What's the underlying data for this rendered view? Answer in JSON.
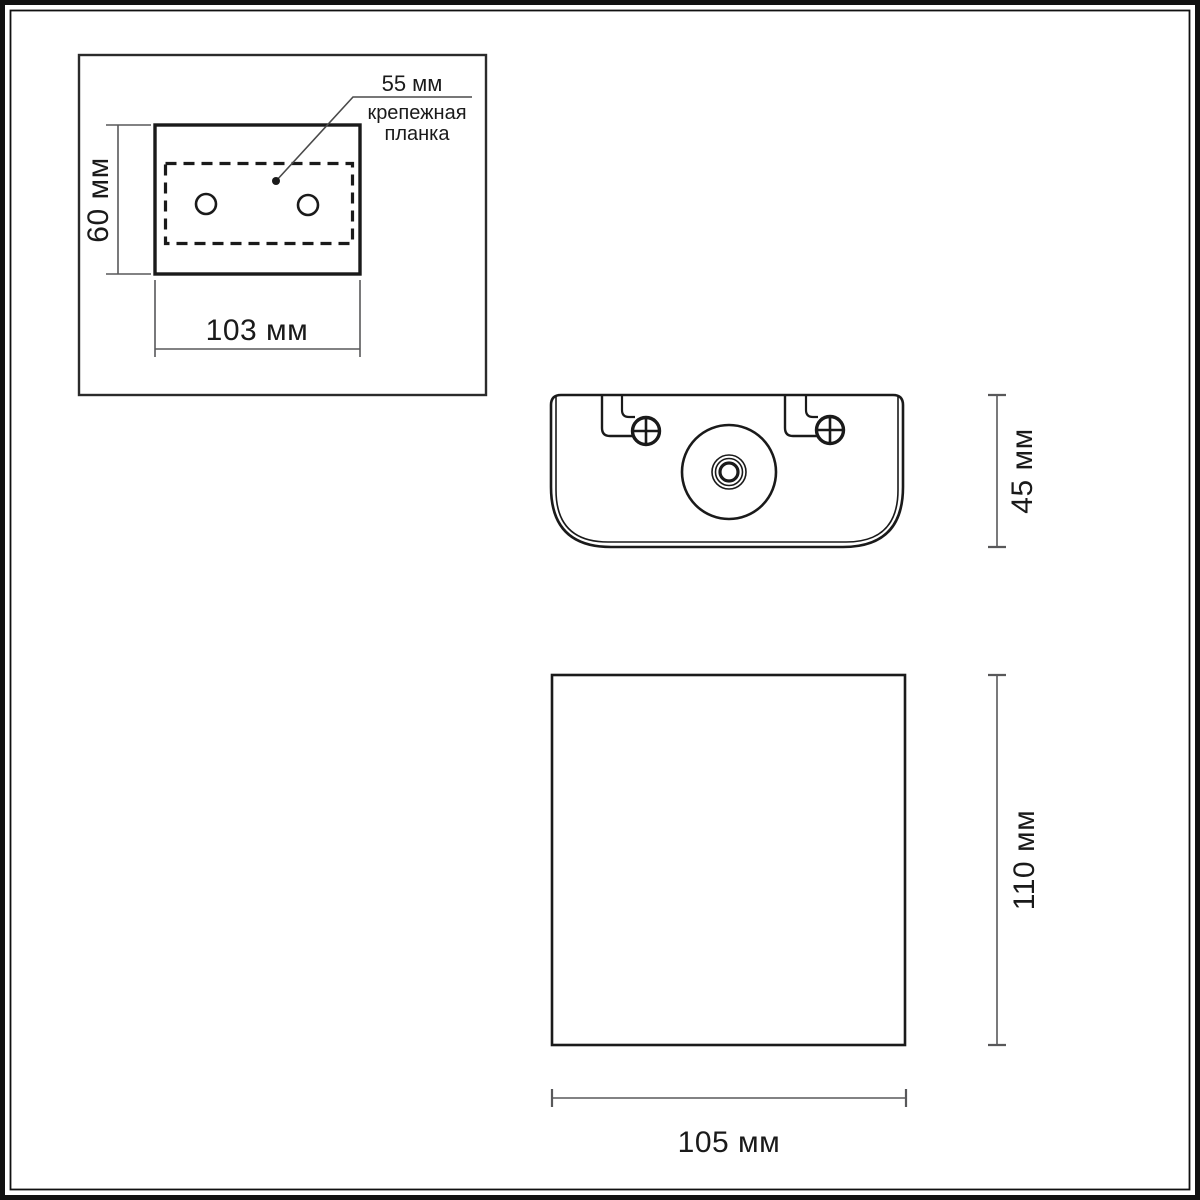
{
  "drawing": {
    "type": "dimensional-drawing",
    "units": "мм",
    "mounting_plate_panel": {
      "height_label": "60 мм",
      "width_label": "103 мм",
      "hole_spacing_label": "55 мм",
      "callout_line1": "крепежная",
      "callout_line2": "планка"
    },
    "top_view": {
      "depth_label": "45 мм"
    },
    "front_view": {
      "height_label": "110 мм",
      "width_label": "105 мм"
    }
  },
  "colors": {
    "outline": "#1a1a1a",
    "panel_border": "#2b2b2b",
    "dim_line": "#58585a",
    "leader_line": "#4a4a4a",
    "background": "#ffffff",
    "frame": "#111111"
  }
}
